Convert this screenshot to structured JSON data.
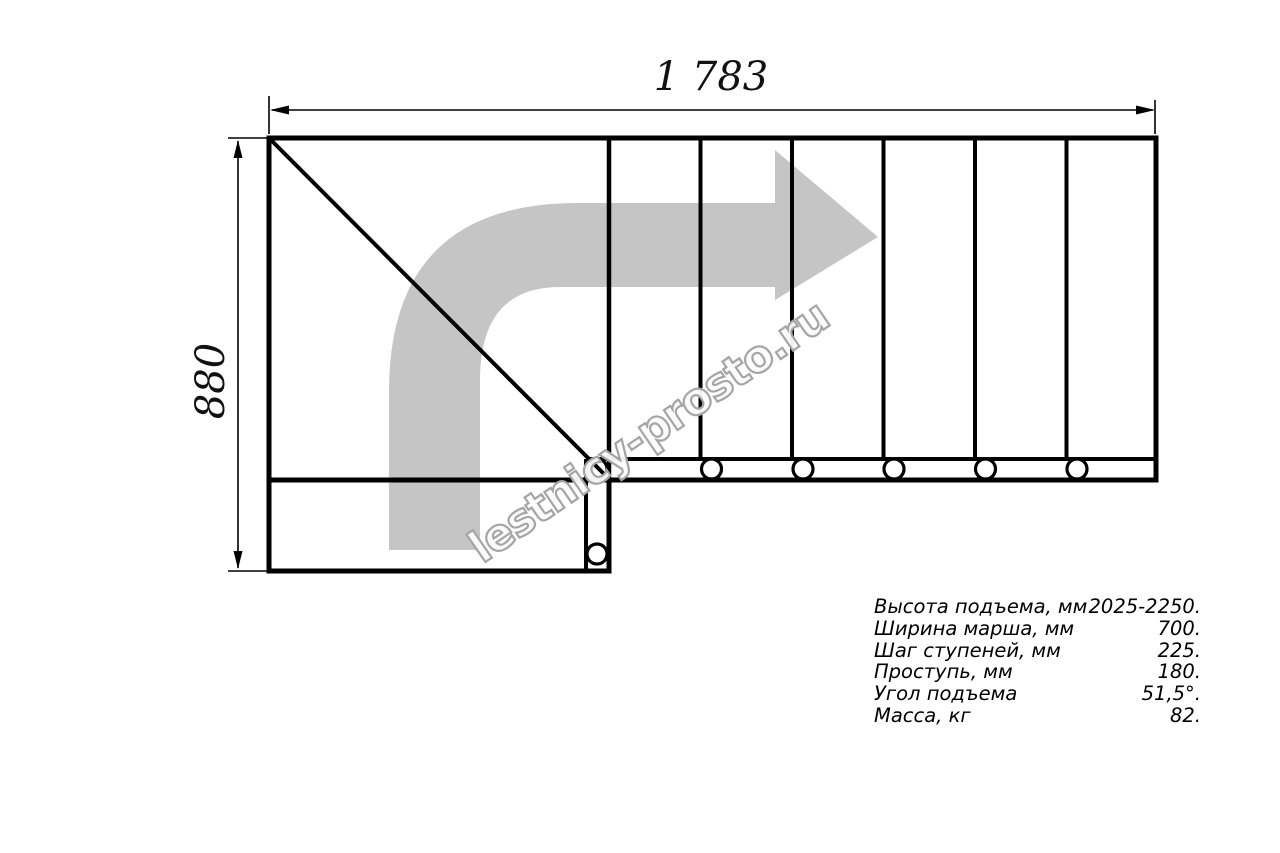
{
  "title": "staircase-plan-drawing",
  "colors": {
    "line": "#000000",
    "arrow_gray": "#c5c5c5",
    "watermark_gray": "#a5a5a5",
    "background": "#ffffff"
  },
  "dimensions": {
    "width_label": "1 783",
    "height_label": "880"
  },
  "watermark": {
    "text": "lestnicy-prosto.ru"
  },
  "specs": {
    "rows": [
      {
        "label": "Высота подъема, мм",
        "value": "2025-2250."
      },
      {
        "label": "Ширина марша, мм",
        "value": "700."
      },
      {
        "label": "Шаг ступеней, мм",
        "value": "225."
      },
      {
        "label": "Проступь, мм",
        "value": "180."
      },
      {
        "label": "Угол подъема",
        "value": "51,5°."
      },
      {
        "label": "Масса, кг",
        "value": "82."
      }
    ]
  }
}
